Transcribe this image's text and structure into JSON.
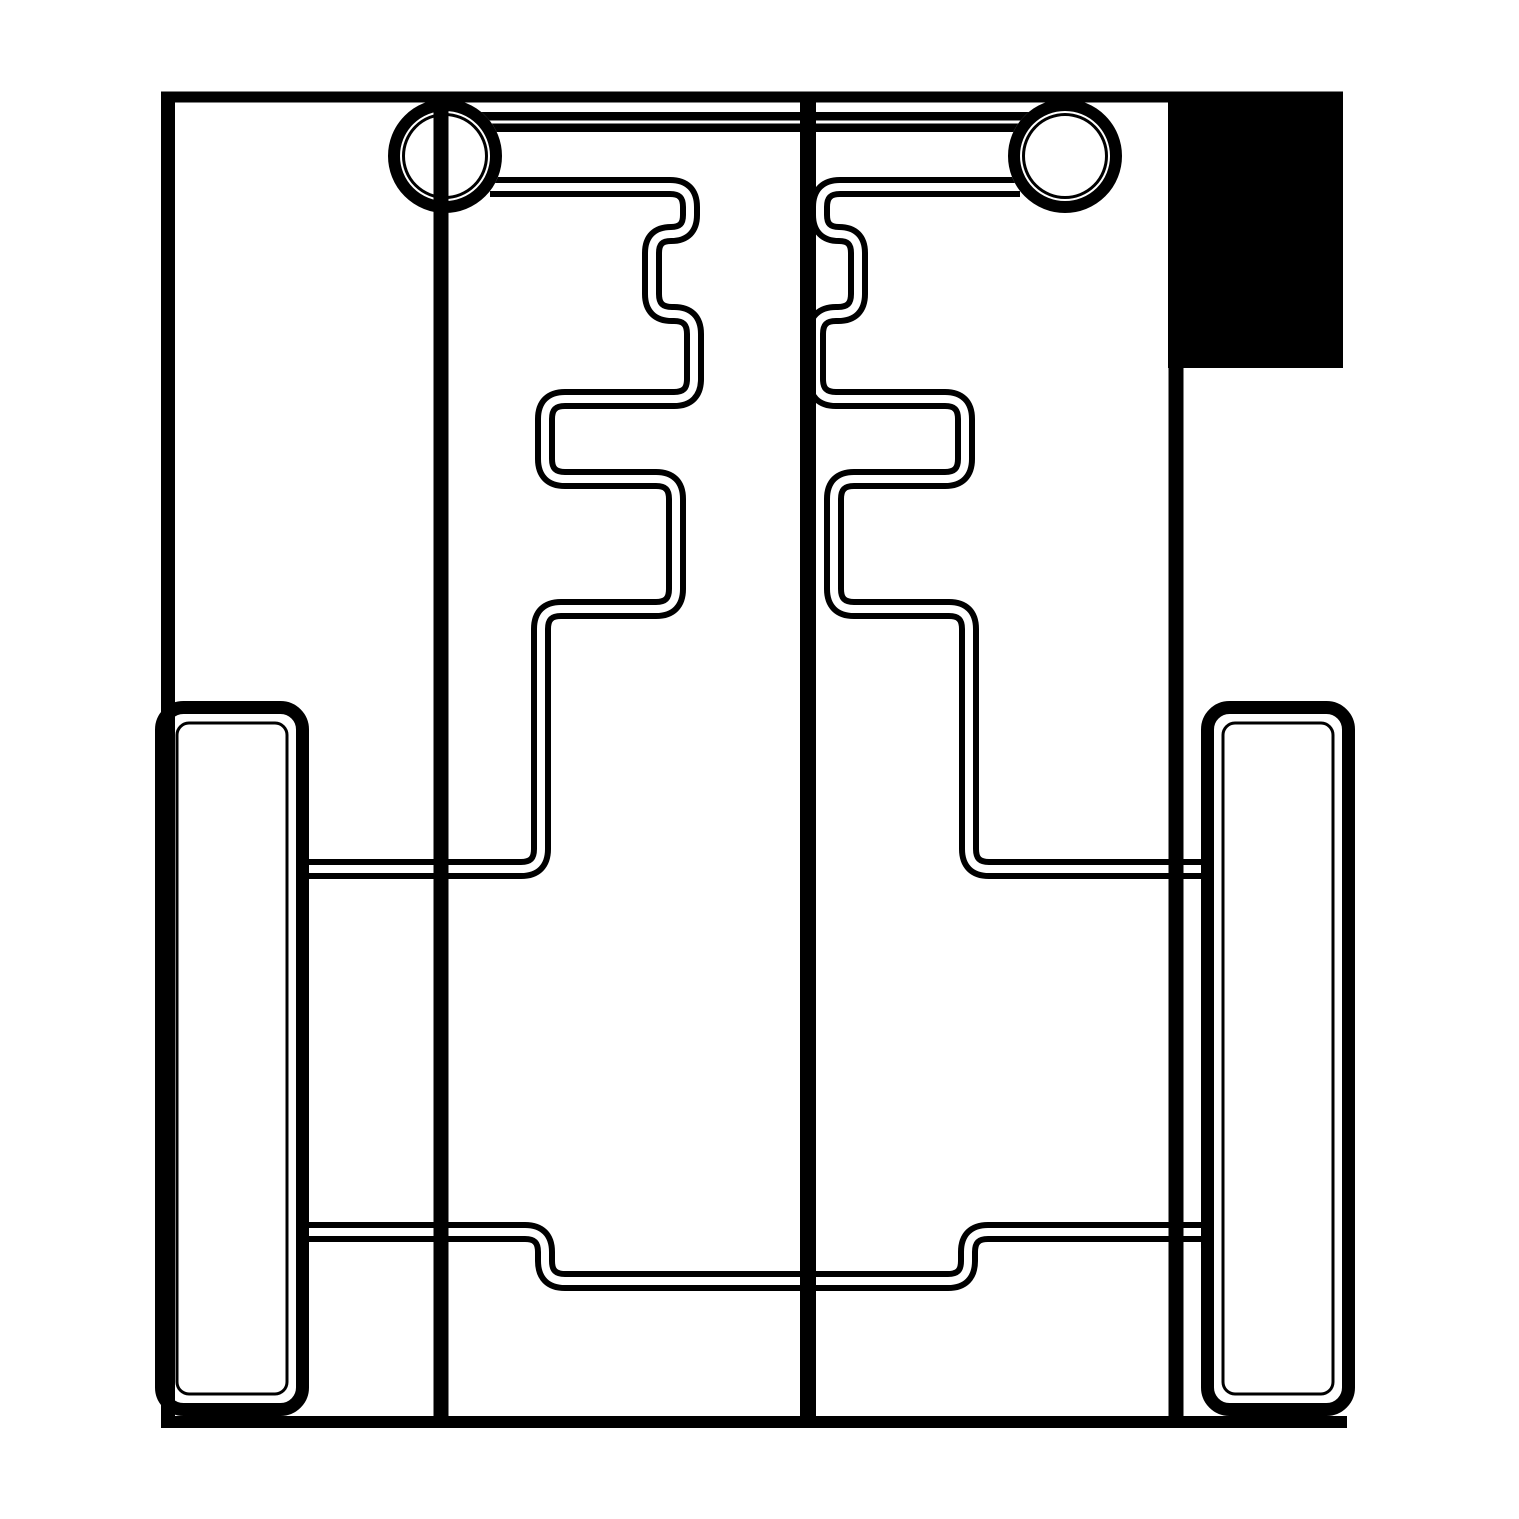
{
  "document": {
    "kind": "cad-line-diagram",
    "description": "Monochrome CNC-style cut layout drawing: outer frame, two wheel circles joined by a crossbar, mirrored stepped comb profiles, two tall rounded skid rectangles, a stepped bottom channel and a solid filled pocket rectangle at the top right.",
    "background_color": "#ffffff",
    "ink_color": "#000000",
    "canvas": {
      "width": 1519,
      "height": 1519
    }
  },
  "styles": {
    "double_outer_width": 20,
    "double_inner_width": 8,
    "corner_radius": 20
  },
  "shapes": [
    {
      "name": "pocket-fill-rect",
      "type": "rect_fill",
      "x": 1168,
      "y": 92,
      "w": 175,
      "h": 276,
      "color": "#000000"
    },
    {
      "name": "crossbar-line",
      "type": "double_path",
      "outer_w": 20,
      "inner_w": 3,
      "r": 0,
      "points": [
        [
          466,
          122
        ],
        [
          1044,
          122
        ]
      ]
    },
    {
      "name": "left-step-profile",
      "type": "double_path",
      "outer_w": 20,
      "inner_w": 8,
      "r": 20,
      "points": [
        [
          490,
          187
        ],
        [
          690,
          187
        ],
        [
          690,
          234
        ],
        [
          652,
          234
        ],
        [
          652,
          314
        ],
        [
          694,
          314
        ],
        [
          694,
          399
        ],
        [
          545,
          399
        ],
        [
          545,
          479
        ],
        [
          676,
          479
        ],
        [
          676,
          609
        ],
        [
          541,
          609
        ],
        [
          541,
          869
        ],
        [
          302,
          869
        ]
      ]
    },
    {
      "name": "right-step-profile",
      "type": "double_path",
      "outer_w": 20,
      "inner_w": 8,
      "r": 20,
      "points": [
        [
          1020,
          187
        ],
        [
          820,
          187
        ],
        [
          820,
          234
        ],
        [
          858,
          234
        ],
        [
          858,
          314
        ],
        [
          816,
          314
        ],
        [
          816,
          399
        ],
        [
          965,
          399
        ],
        [
          965,
          479
        ],
        [
          834,
          479
        ],
        [
          834,
          609
        ],
        [
          969,
          609
        ],
        [
          969,
          869
        ],
        [
          1208,
          869
        ]
      ]
    },
    {
      "name": "bottom-channel-profile",
      "type": "double_path",
      "outer_w": 20,
      "inner_w": 8,
      "r": 20,
      "points": [
        [
          302,
          1232
        ],
        [
          545,
          1232
        ],
        [
          545,
          1281
        ],
        [
          968,
          1281
        ],
        [
          968,
          1232
        ],
        [
          1208,
          1232
        ]
      ]
    },
    {
      "name": "left-skid-rect",
      "type": "double_rect",
      "outer": [
        161.5,
        707.5,
        302.5,
        1409.5
      ],
      "outer_rx": 22,
      "outer_w": 13,
      "inner": [
        177,
        723,
        287,
        1394
      ],
      "inner_rx": 12,
      "inner_w": 3
    },
    {
      "name": "right-skid-rect",
      "type": "double_rect",
      "outer": [
        1207.5,
        707.5,
        1348.5,
        1409.5
      ],
      "outer_rx": 22,
      "outer_w": 13,
      "inner": [
        1223,
        723,
        1333,
        1394
      ],
      "inner_rx": 12,
      "inner_w": 3
    },
    {
      "name": "left-wheel-circle",
      "type": "circle_ring",
      "cx": 445,
      "cy": 156,
      "disk_r": 57,
      "ring_r": 51,
      "ring_w": 12,
      "inner_r": 41.5,
      "inner_w": 3
    },
    {
      "name": "right-wheel-circle",
      "type": "circle_ring",
      "cx": 1065,
      "cy": 156,
      "disk_r": 57,
      "ring_r": 51,
      "ring_w": 12,
      "inner_r": 41.5,
      "inner_w": 3
    },
    {
      "name": "left-axle-line",
      "type": "line",
      "x1": 441,
      "y1": 97,
      "x2": 441,
      "y2": 1422,
      "w": 15
    },
    {
      "name": "center-spine-line",
      "type": "line",
      "x1": 808,
      "y1": 97,
      "x2": 808,
      "y2": 1422,
      "w": 16
    },
    {
      "name": "frame-top-edge",
      "type": "line",
      "x1": 161,
      "y1": 97,
      "x2": 1343,
      "y2": 97,
      "w": 11
    },
    {
      "name": "frame-left-edge",
      "type": "line",
      "x1": 168,
      "y1": 92,
      "x2": 168,
      "y2": 1428,
      "w": 14
    },
    {
      "name": "frame-right-edge",
      "type": "line",
      "x1": 1176,
      "y1": 92,
      "x2": 1176,
      "y2": 1428,
      "w": 15
    },
    {
      "name": "frame-bottom-edge",
      "type": "line",
      "x1": 161,
      "y1": 1422,
      "x2": 1347,
      "y2": 1422,
      "w": 12
    }
  ]
}
